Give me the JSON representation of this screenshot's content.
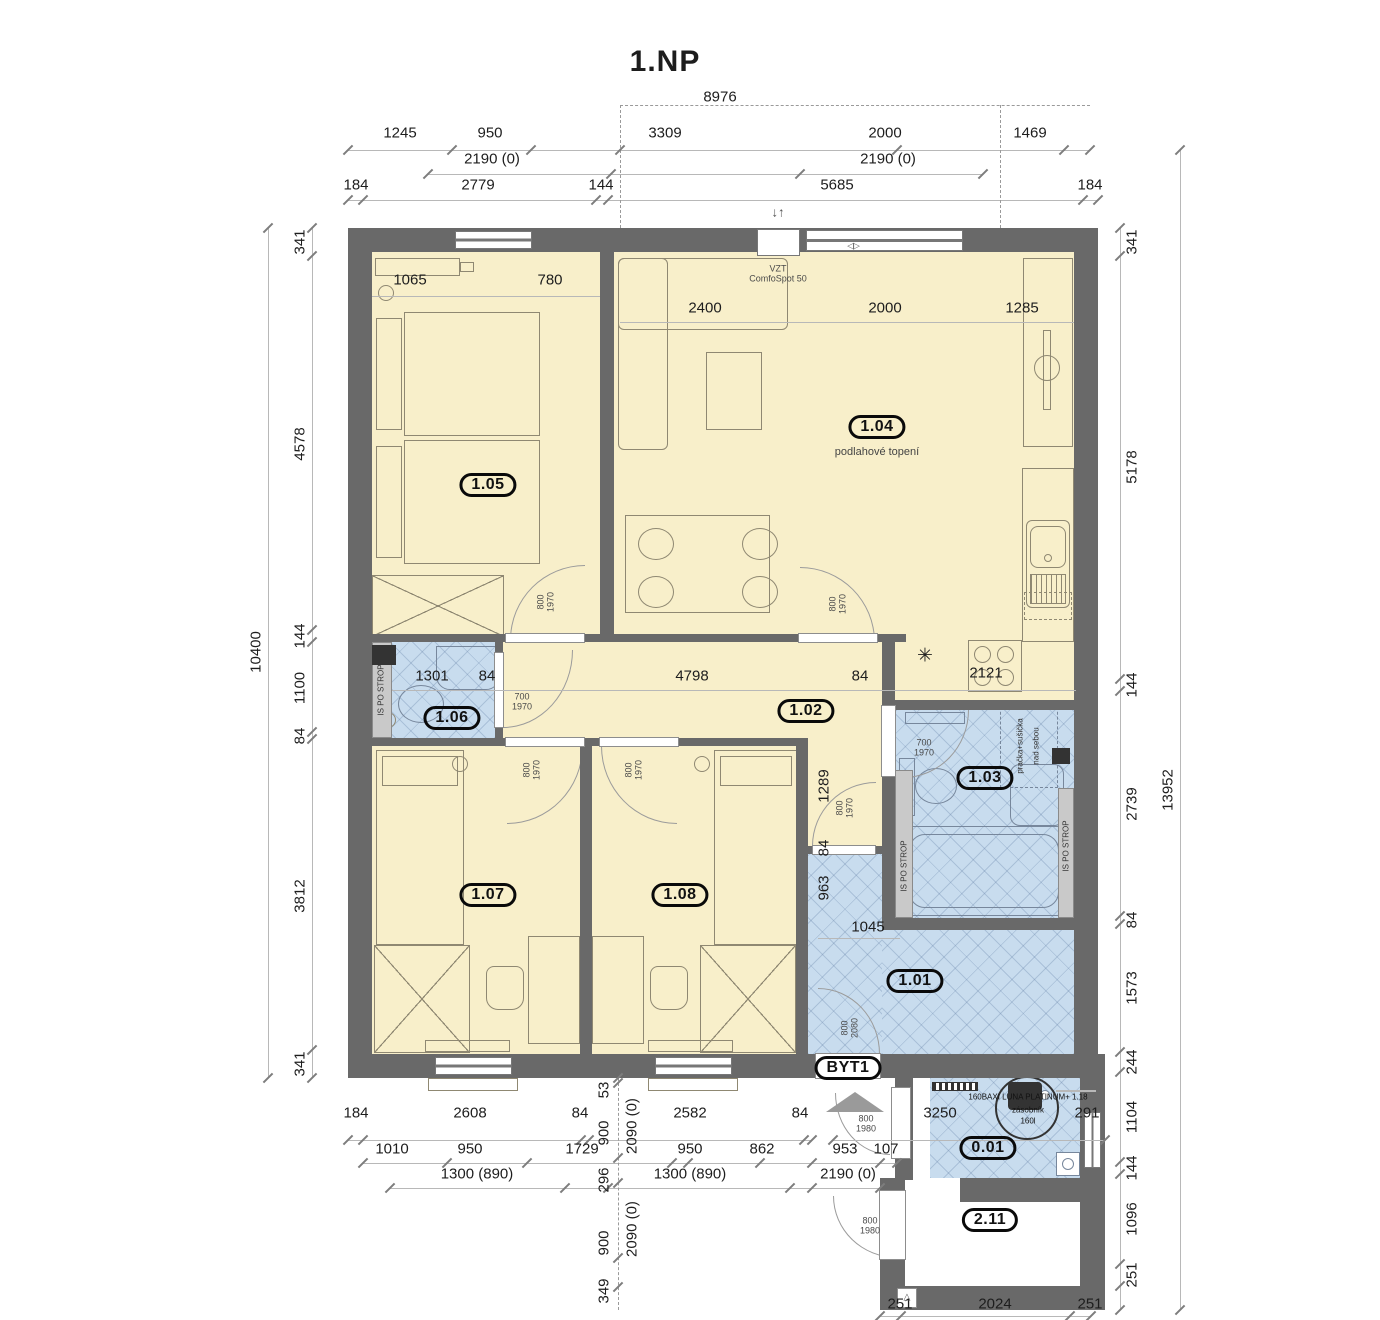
{
  "title": "1.NP",
  "colors": {
    "wall": "#696969",
    "dry_room": "#f8efca",
    "wet_room": "#c8dcee",
    "shaft": "#c9c9c9",
    "dim_line": "#b8b8b8",
    "dim_text": "#1d1d1d"
  },
  "rooms": {
    "r101": "1.01",
    "r102": "1.02",
    "r103": "1.03",
    "r104": "1.04",
    "r105": "1.05",
    "r106": "1.06",
    "r107": "1.07",
    "r108": "1.08",
    "r001": "0.01",
    "r211": "2.11",
    "byt": "BYT1"
  },
  "notes": {
    "vzt_line1": "VZT",
    "vzt_line2": "ComfoSpot 50",
    "floor_heating": "podlahové topení",
    "shaft": "IS PO STROP",
    "washer_line1": "pračka+sušička",
    "washer_line2": "nad sebou",
    "boiler": "160BAXI LUNA PLATINUM+ 1.18",
    "tank_line1": "zásobník",
    "tank_line2": "160l",
    "flue": "✳",
    "vent_arrows": "↓↑",
    "slide_arrows": "◁▷",
    "door_mark": "△"
  },
  "doors": {
    "w700": "700",
    "w800": "800",
    "h1970": "1970",
    "h1980": "1980",
    "h2080": "2080"
  },
  "dims": {
    "top_overall": "8976",
    "top_row1": [
      "1245",
      "950",
      "3309",
      "2000",
      "1469"
    ],
    "top_row2": [
      "2190 (0)",
      "2190 (0)"
    ],
    "top_row3": [
      "184",
      "2779",
      "144",
      "5685",
      "184"
    ],
    "left_chain": [
      "341",
      "4578",
      "144",
      "1100",
      "84",
      "3812",
      "341"
    ],
    "left_overall": "10400",
    "right_chain": [
      "341",
      "5178",
      "144",
      "2739",
      "84",
      "1573",
      "244",
      "1104",
      "144",
      "1096",
      "251"
    ],
    "right_overall": "13952",
    "bottom_row1": [
      "184",
      "2608",
      "84",
      "2582",
      "84"
    ],
    "bottom_row2": [
      "1010",
      "950",
      "1729",
      "950",
      "862",
      "953",
      "107"
    ],
    "bottom_row3": [
      "1300 (890)",
      "1300 (890)",
      "2190 (0)"
    ],
    "bottom_mid_v": [
      "53",
      "900",
      "296",
      "900",
      "349"
    ],
    "bottom_mid_v2": [
      "2090 (0)",
      "2090 (0)"
    ],
    "bottom_right": [
      "3250",
      "291"
    ],
    "bottom_edge": [
      "251",
      "2024",
      "251"
    ],
    "interior_r105": [
      "1065",
      "780"
    ],
    "interior_r104": [
      "2400",
      "2000",
      "1285"
    ],
    "interior_mid": [
      "1301",
      "84",
      "4798",
      "84",
      "2121"
    ],
    "interior_hall": [
      "1289",
      "84",
      "963",
      "1045"
    ]
  }
}
